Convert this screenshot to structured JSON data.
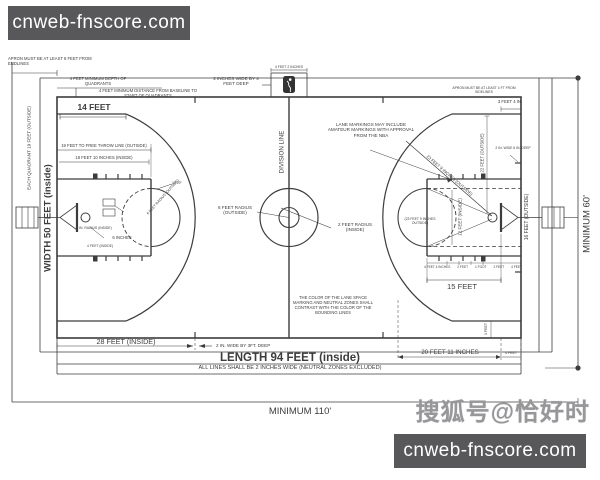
{
  "colors": {
    "line": "#3c3c3c",
    "watermark_bg": "#58585a",
    "watermark_text": "#ffffff",
    "sohu_gray": "#97979a",
    "logo_dark": "#333333"
  },
  "watermarks": {
    "site": "cnweb-fnscore.com",
    "sohu": "搜狐号@恰好时"
  },
  "labels": {
    "apron_endlines": "APRON MUST BE AT LEAST 8 FEET FROM ENDLINES",
    "quadrant_depth": "4 FEET MINIMUM DEPTH OF QUADRANTS",
    "quadrant_distance": "4 FEET MINIMUM DISTANCE FROM BASELINE TO START OF QUADRANTS",
    "fourteen_feet": "14 FEET",
    "division_hash": "2 INCHES WIDE BY 4 FEET DEEP",
    "logo_dim": "4 FEET 2 INCHES",
    "apron_sidelines": "APRON MUST BE AT LEAST 4 FT FROM SIDELINES",
    "backboard_face": "3 FEET 4 IN.",
    "division_line": "DIVISION LINE",
    "amateur_note": "LANE MARKINGS MAY INCLUDE AMATEUR MARKINGS WITH APPROVAL FROM THE NBA",
    "center_outer": "6 FEET RADIUS (OUTSIDE)",
    "center_inner": "2 FEET RADIUS (INSIDE)",
    "each_quadrant": "EACH QUADRANT 19 FEET (OUTSIDE)",
    "width": "WIDTH 50 FEET (inside)",
    "ft_outside": "19 FEET TO FREE THROW LINE (OUTSIDE)",
    "ft_inside": "18 FEET 10 INCHES (INSIDE)",
    "angle": "12.29°",
    "ft_circle_radius": "6 FEET RADIUS (OUTSIDE)",
    "rim_radius": "9 IN. RADIUS (INSIDE)",
    "six_inches": "6 INCHES",
    "four_feet_inside": "4 FEET (INSIDE)",
    "twenty_eight": "28 FEET (INSIDE)",
    "neutral_zone": "2 IN. WIDE BY 3FT. DEEP",
    "length": "LENGTH 94 FEET (inside)",
    "all_lines": "ALL LINES SHALL BE 2 INCHES WIDE (NEUTRAL ZONES EXCLUDED)",
    "lane_color": "THE COLOR OF THE LANE SPACE MARKING AND NEUTRAL ZONES SHALL CONTRAST WITH THE COLOR OF THE BOUNDING LINES",
    "twenty_ft_eleven": "20 FEET 11 INCHES",
    "four_feet": "4 FEET",
    "three_feet": "3 FEET",
    "three_pt_radius": "23 FEET 9 INCHES (OUTSIDE)",
    "three_pt_radius_h": "(23 FEET 9 INCHES OUTSIDE)",
    "twenty_two": "22 FEET (OUTSIDE)",
    "twelve_inside": "12 FEET (INSIDE)",
    "sixteen_outside": "16 FEET (OUTSIDE)",
    "fifteen": "15 FEET",
    "endline_hash": "2 IN. WIDE 6 IN. DEEP",
    "minimum_60": "MINIMUM 60'",
    "minimum_110": "MINIMUM 110'",
    "lane_marks": [
      "4 FEET 4 INCHES",
      "2 FEET",
      "1 FOOT",
      "2 FEET",
      "4 FEET"
    ]
  }
}
